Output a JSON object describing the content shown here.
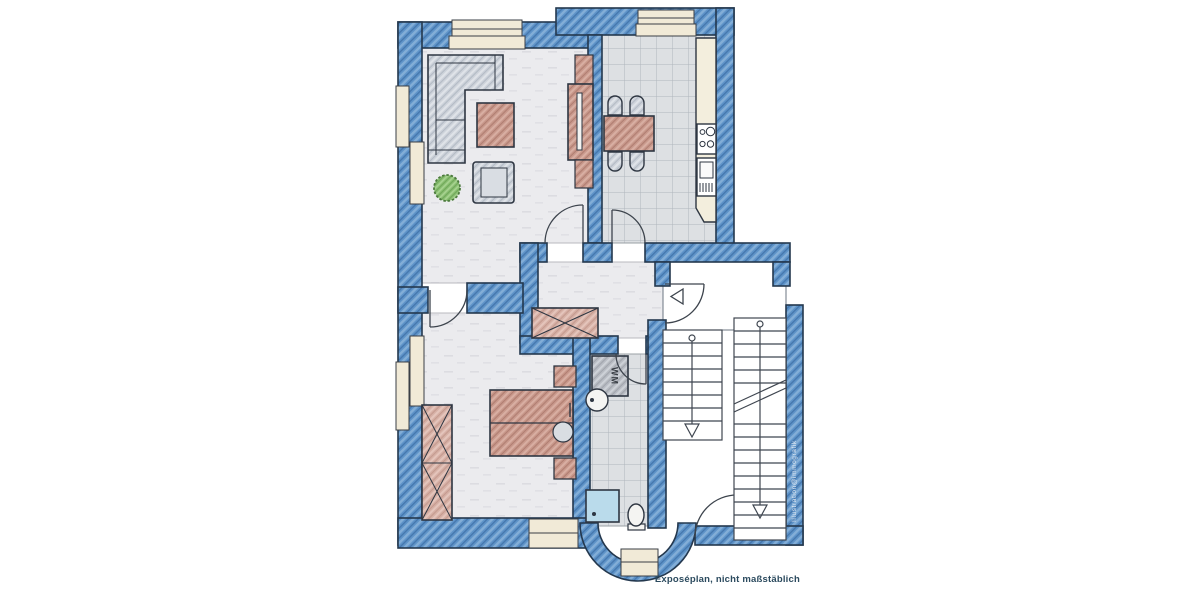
{
  "plan": {
    "caption": "Exposéplan, nicht maßstäblich",
    "watermark": "Illustration@immografik",
    "labels": {
      "washing_machine": "WM"
    },
    "colors": {
      "wall_blue": "#5e93c8",
      "wall_outline": "#24384e",
      "floor_plaster": "#ebebee",
      "floor_tile": "#dde0e3",
      "furniture_red": "#c8988b",
      "furniture_gray": "#cdd2da",
      "window_cream": "#f1ead7",
      "plant_green": "#8bbf72",
      "shower_blue": "#badbeb",
      "caption_color": "#2b4a5e"
    },
    "rooms": [
      "living-room",
      "kitchen",
      "hallway",
      "bedroom",
      "bathroom",
      "stairwell"
    ],
    "furniture": {
      "living_room": [
        "corner-sofa",
        "coffee-table",
        "armchair",
        "plant",
        "tv-sideboard"
      ],
      "kitchen": [
        "dining-table",
        "four-chairs",
        "kitchen-counter",
        "cooktop",
        "oven"
      ],
      "hallway": [
        "wardrobe"
      ],
      "bedroom": [
        "double-bed",
        "nightstands",
        "wardrobe"
      ],
      "bathroom": [
        "washing-machine",
        "sink",
        "shower",
        "toilet"
      ],
      "stairwell": [
        "stair-flight-down",
        "stair-flight-up",
        "entrance-door"
      ]
    }
  }
}
